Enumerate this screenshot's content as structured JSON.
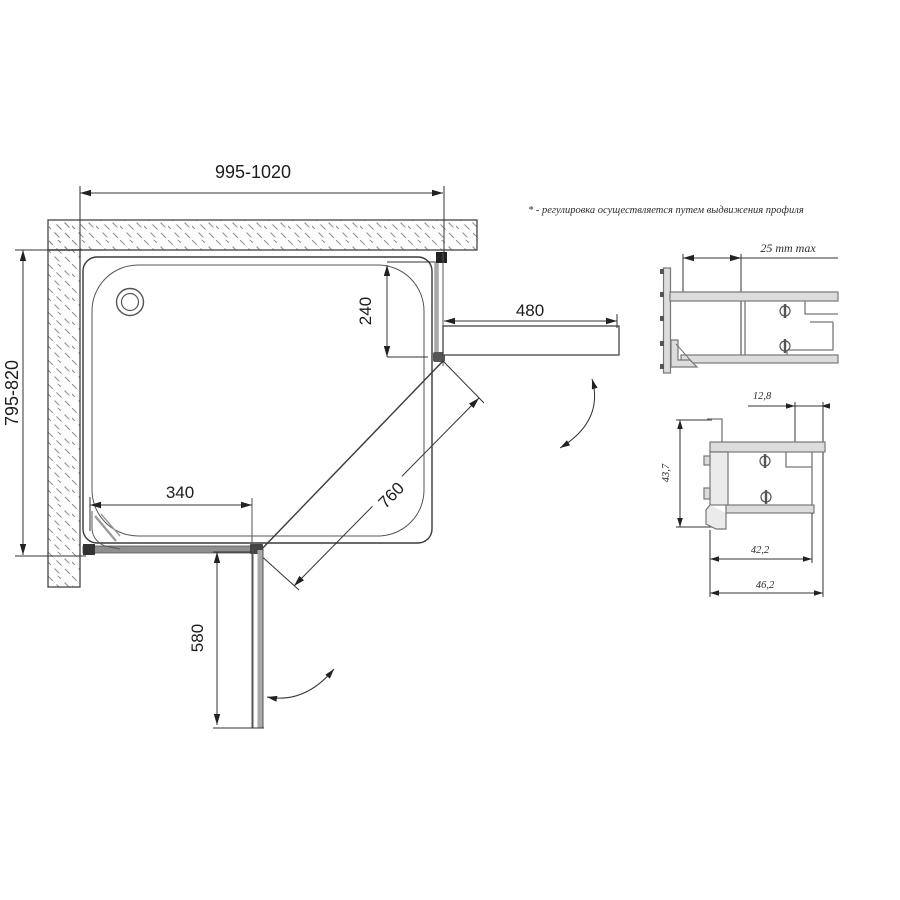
{
  "note": "* - регулировка осуществляется путем выдвижения профиля",
  "plan": {
    "width": "995-1020",
    "depth": "795-820",
    "fixed_right_depth": "240",
    "door_open_right": "480",
    "fixed_bottom_width": "340",
    "door_width": "760",
    "door_open_bottom": "580"
  },
  "detail_top": {
    "adjust": "25 mm max"
  },
  "detail_bottom": {
    "top_width": "12,8",
    "left_height": "43,7",
    "inner_width": "42,2",
    "outer_width": "46,2"
  },
  "colors": {
    "line": "#3a3a3a",
    "dim": "#333333",
    "glass": "#a9a9a9",
    "panel_band": "#8f8f8f",
    "profile_fill": "#dcdcdc",
    "hatch": "#8a8a8a",
    "background": "#ffffff"
  }
}
